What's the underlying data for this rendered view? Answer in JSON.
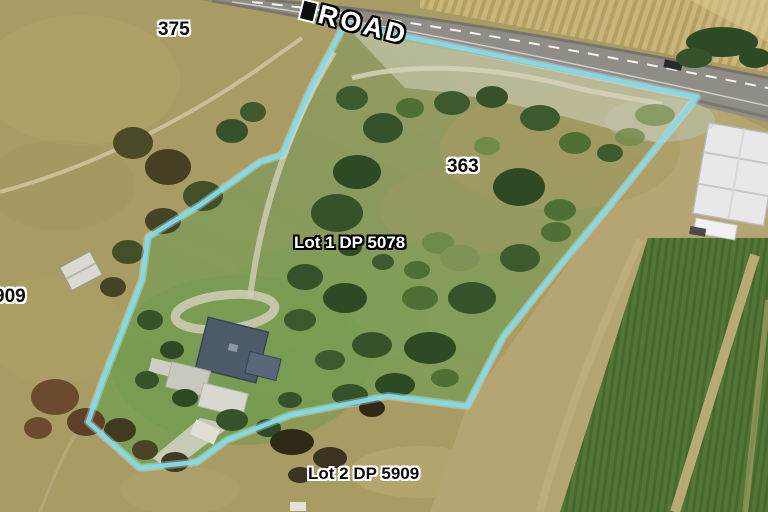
{
  "map": {
    "type": "aerial-parcel-view",
    "road_name": "ROAD",
    "labels": {
      "neighbor_number": "375",
      "parcel_number": "363",
      "lot1": "Lot 1 DP 5078",
      "lot2": "Lot 2 DP 5909",
      "lot_edge_partial": "909"
    },
    "colors": {
      "boundary": "#7fdcec",
      "field": "#a89b63",
      "road": "#8f8d86",
      "crops": "#507433",
      "label_dark": "#0c0c0c",
      "label_light": "#ffffff"
    }
  }
}
